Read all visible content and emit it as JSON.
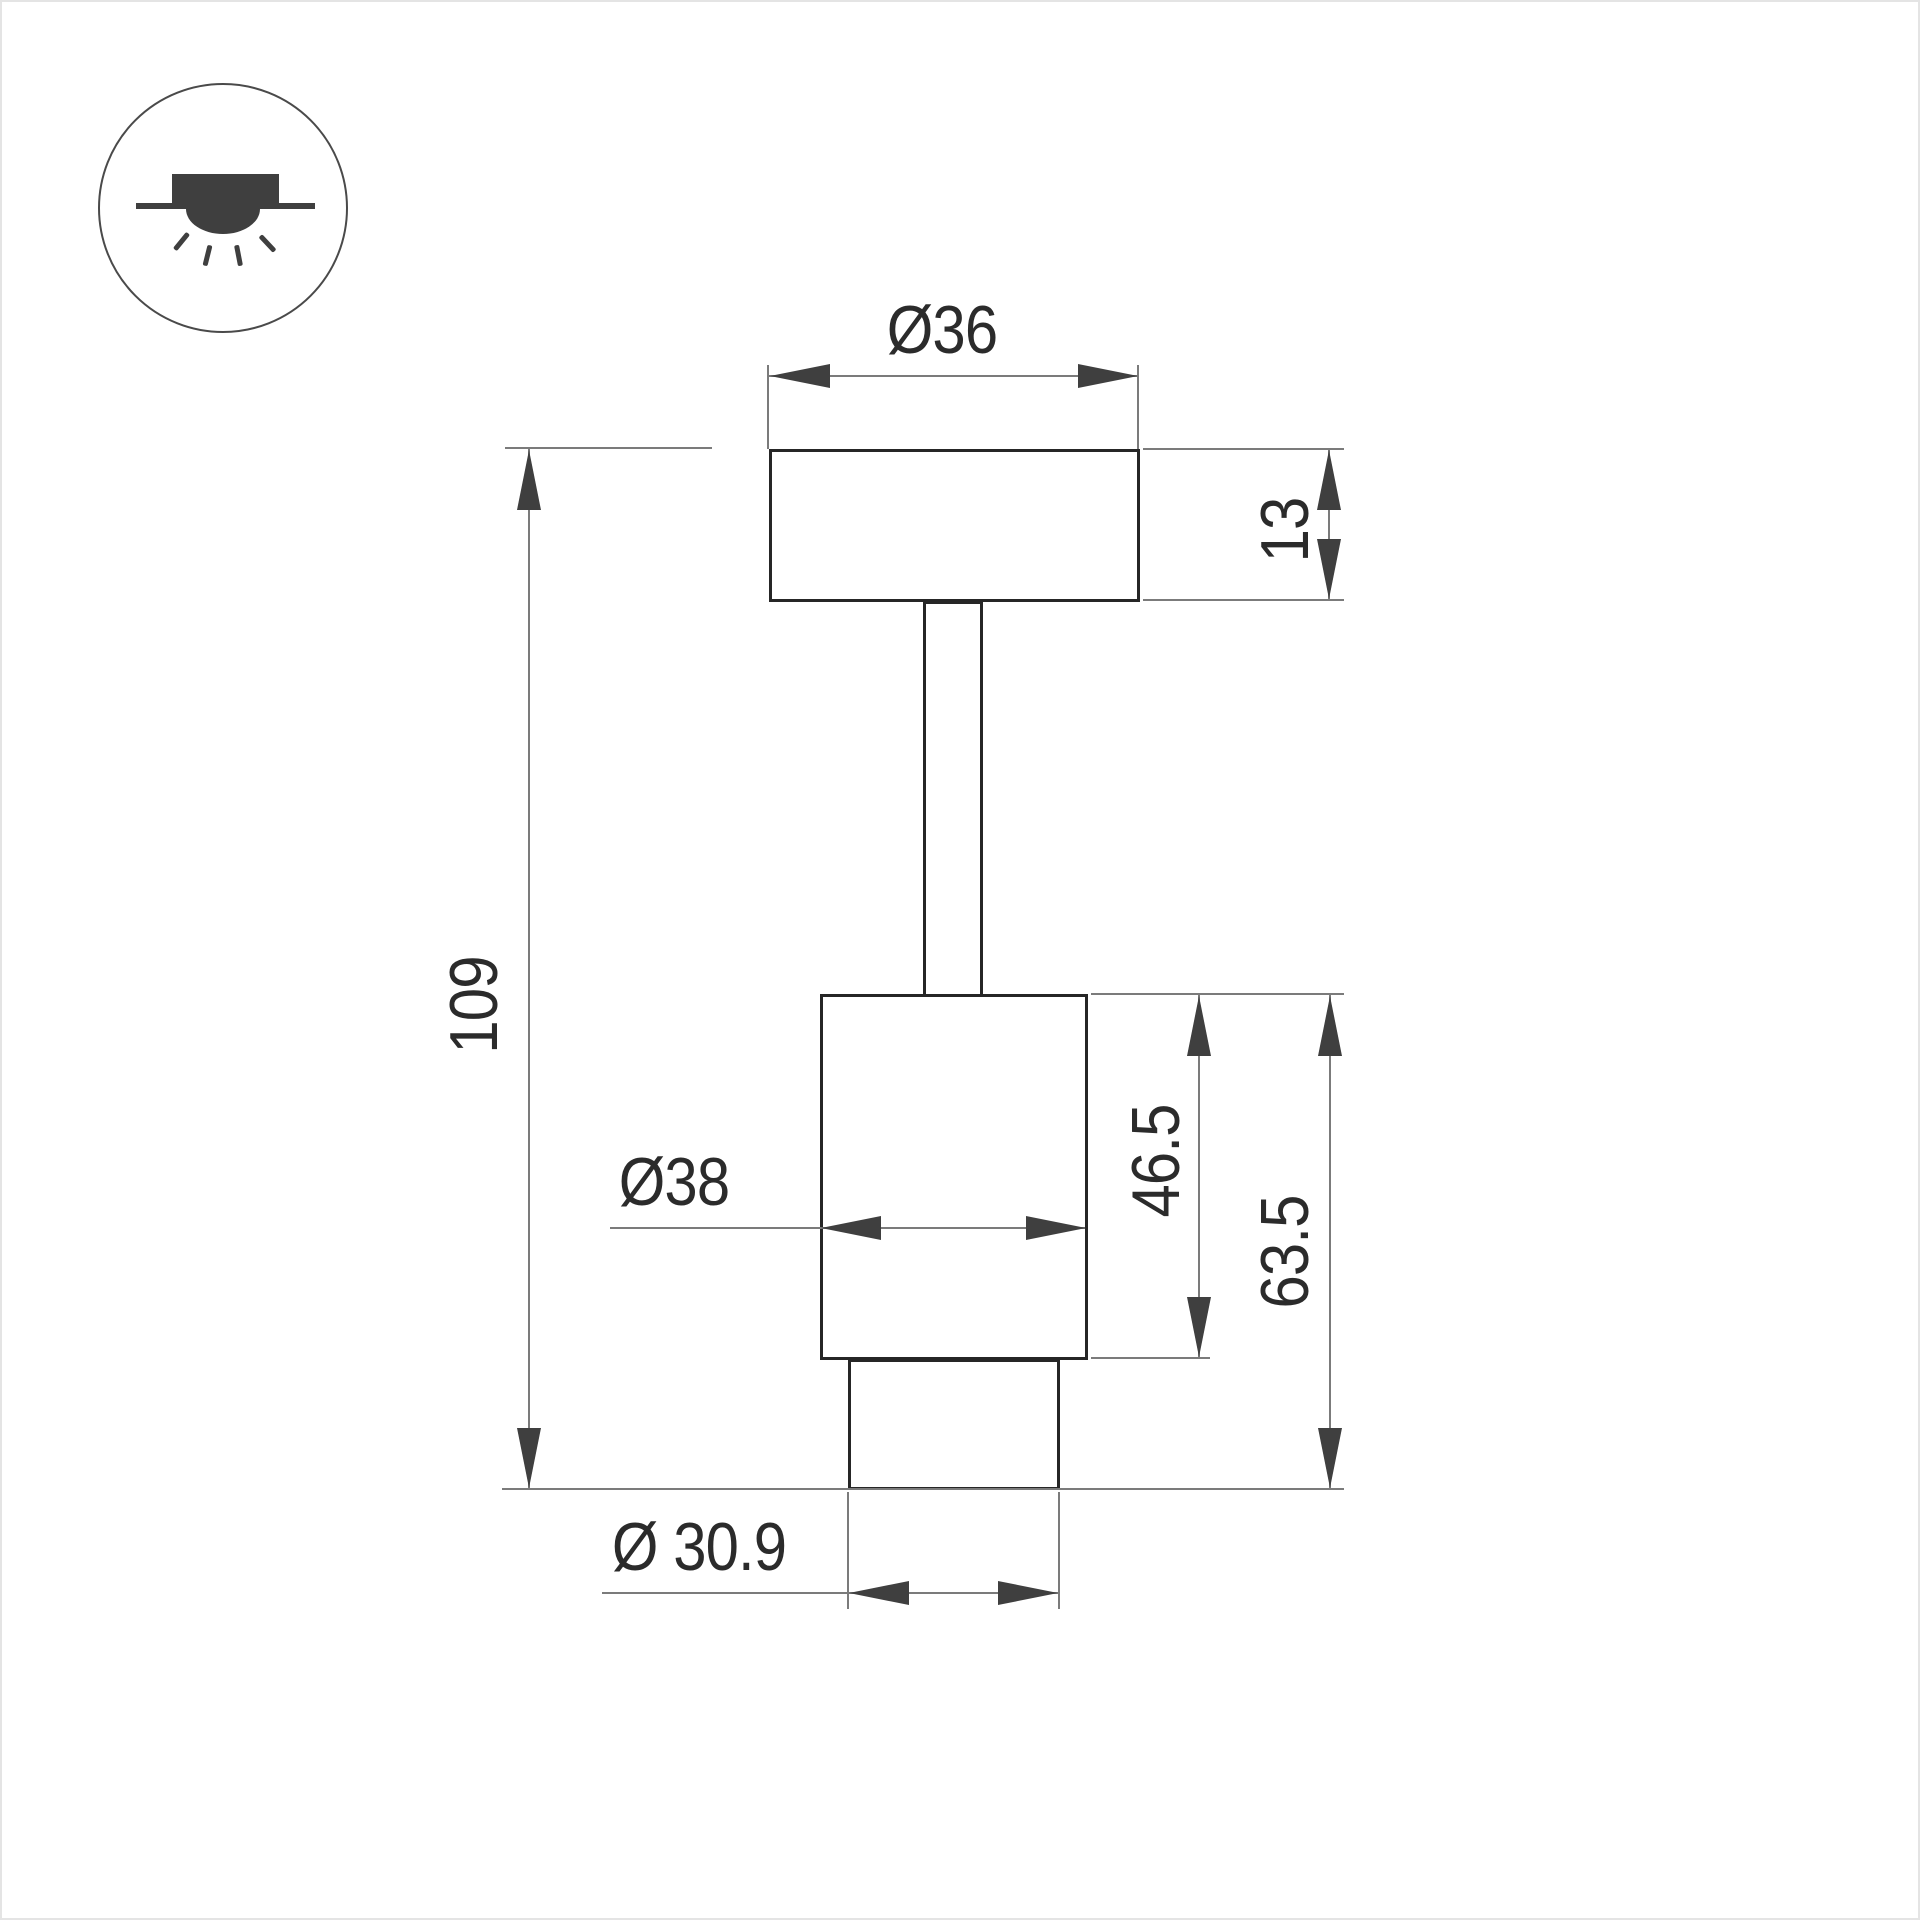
{
  "page": {
    "background": "#ffffff",
    "border_color": "#e4e4e4"
  },
  "legend": {
    "icon": "recessed-downlight-icon"
  },
  "drawing": {
    "type": "technical-dimension-drawing",
    "dimensions": {
      "canopy_diameter": "Ø36",
      "canopy_thickness": "13",
      "overall_height": "109",
      "body_diameter": "Ø38",
      "body_height": "46.5",
      "body_plus_trim_height": "63.5",
      "trim_diameter": "Ø 30.9"
    },
    "colors": {
      "object_line": "#262626",
      "dimension_line": "#7b7b7b",
      "arrow": "#3f3f3f",
      "text": "#2b2b2b",
      "icon": "#3f3f3f"
    }
  }
}
